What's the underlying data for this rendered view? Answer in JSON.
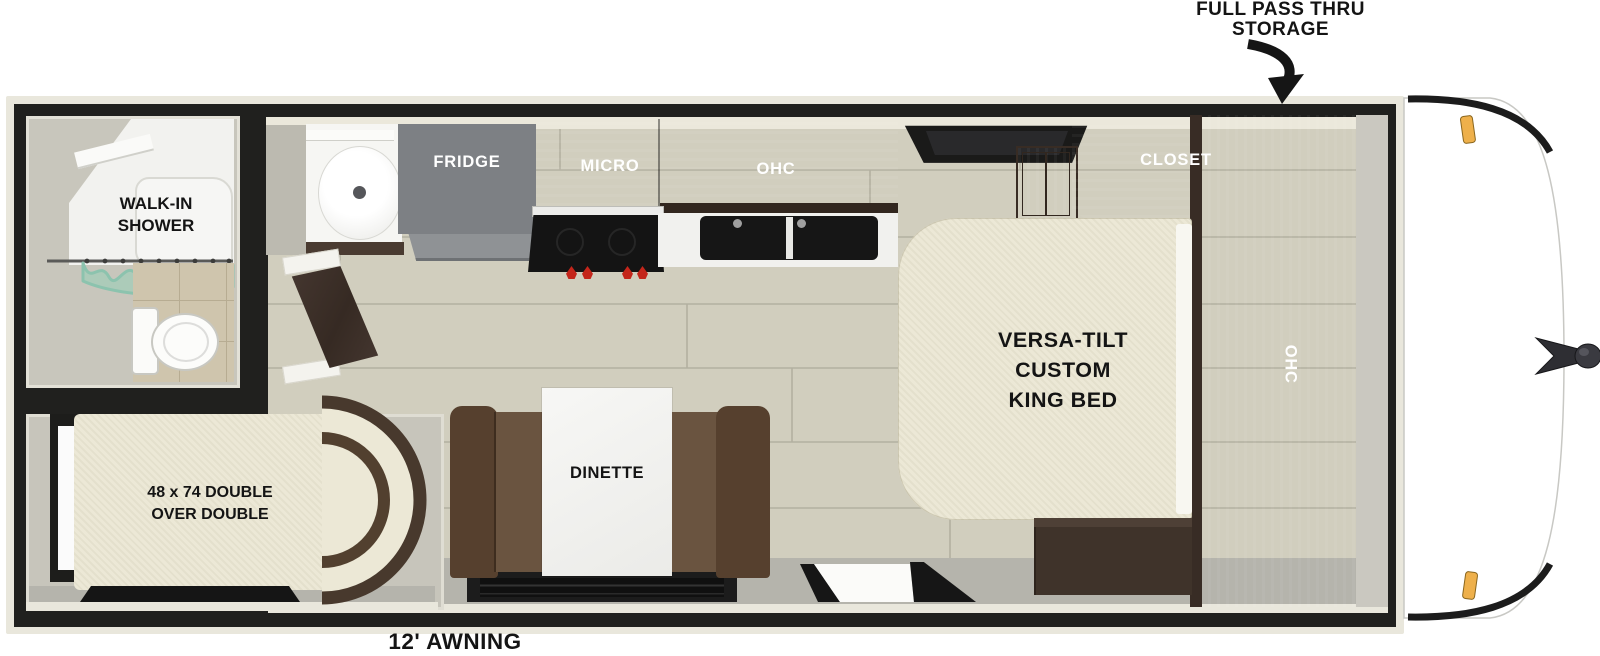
{
  "callouts": {
    "storage_line1": "FULL PASS THRU",
    "storage_line2": "STORAGE",
    "awning": "12' AWNING"
  },
  "bathroom": {
    "shower_line1": "WALK-IN",
    "shower_line2": "SHOWER"
  },
  "kitchen": {
    "fridge": "FRIDGE",
    "micro": "MICRO",
    "ohc": "OHC"
  },
  "bedroom": {
    "closet": "CLOSET",
    "wardrobe_ohc": "OHC",
    "bed_line1": "VERSA-TILT",
    "bed_line2": "CUSTOM",
    "bed_line3": "KING BED"
  },
  "bunk": {
    "line1": "48 x 74 DOUBLE",
    "line2": "OVER DOUBLE"
  },
  "dinette": {
    "label": "DINETTE"
  },
  "colors": {
    "wall_black": "#20201e",
    "trim_cream": "#e9e7dc",
    "floor_plank": "#d1cebe",
    "wood_dark": "#4a3a30",
    "mattress_cream": "#ece8d6",
    "bench_brown": "#66503b",
    "fridge_gray": "#7d8084",
    "stove_knob_red": "#c4261b",
    "marker_amber": "#eeb04b",
    "curtain_teal": "#8cc3ae"
  }
}
